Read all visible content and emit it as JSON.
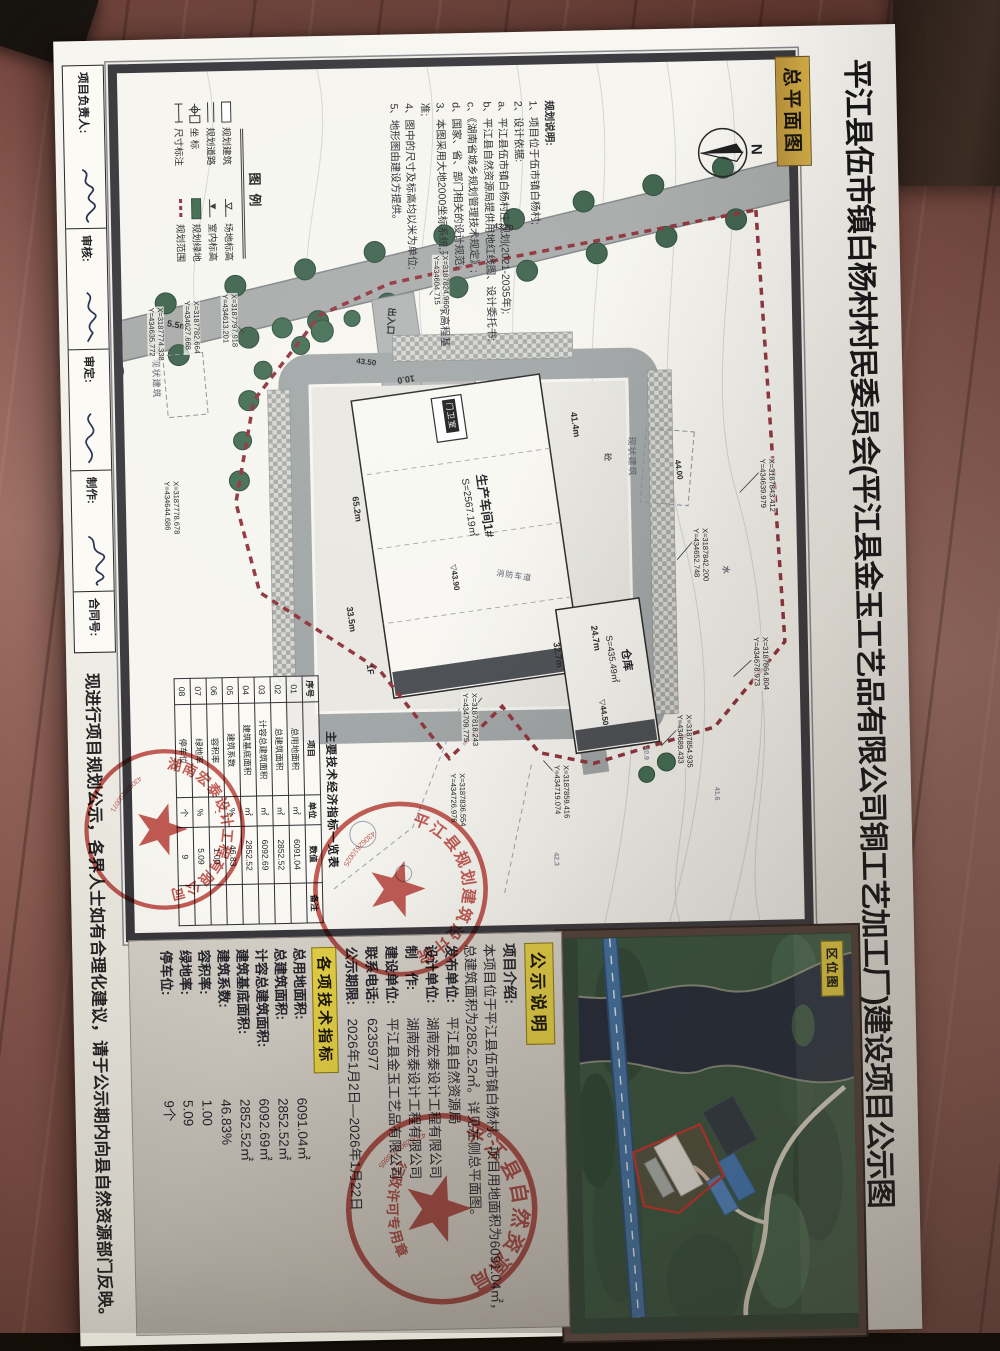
{
  "sheet": {
    "main_title": "平江县伍市镇白杨村村民委员会(平江县金玉工艺品有限公司铜工艺加工厂)建设项目公示图",
    "plan_label": "总平面图",
    "bottom_notice": "现进行项目规划公示，各界人士如有合理化建议，请于公示期内向县自然资源部门反映。",
    "title_block": {
      "fields": [
        "项目负责人:",
        "审核:",
        "审定:",
        "制作:",
        "合同号:"
      ]
    }
  },
  "plan": {
    "north_label": "N",
    "notes": [
      "规划说明:",
      "1、项目位于伍市镇白杨村;",
      "2、设计依据:",
      "a、平江县伍市镇白杨村庄规划(2021-2035年);",
      "b、平江县自然资源局提供用地红线图、设计委托书;",
      "c、《湖南省城乡规划管理技术规定》;",
      "d、国家、省、部门相关的设计规范;",
      "3、本图采用大地2000坐标系统,采用1985国家高程基准;",
      "4、图中的尺寸及标高均以米为单位;",
      "5、地形图由建设方提供。"
    ],
    "legend": {
      "title": "图例",
      "items": [
        "规划建筑",
        "规划道路",
        "坐 标",
        "尺寸标注",
        "场地标高",
        "室内标高",
        "规划绿地",
        "规划范围"
      ]
    },
    "buildings": {
      "workshop": {
        "name": "生产车间1#",
        "area": "S=2567.19㎡",
        "elevation": "43.90",
        "floors": "1F",
        "dim_length": "65.2m",
        "dim_width": "41.4m",
        "dim_wing": "24.7m",
        "dim_side": "33.5m"
      },
      "warehouse": {
        "name": "仓库",
        "area": "S=435.49㎡",
        "elevation": "44.50",
        "dim_length": "32.7m"
      },
      "guard_room": "门卫室"
    },
    "labels": {
      "entrance": "出入口",
      "existing_building": "现状建筑",
      "fire_lane": "消防车道",
      "concrete": "砼",
      "water": "水",
      "road_width": "5.5m",
      "drive_width": "10.0"
    },
    "spot_elevations": [
      "43.20",
      "43.50",
      "44.00",
      "41.6",
      "42.3",
      "40.9"
    ],
    "coordinates": [
      {
        "x": "X=3187824.960",
        "y": "Y=434604.715"
      },
      {
        "x": "X=3187797.918",
        "y": "Y=434613.201"
      },
      {
        "x": "X=3187782.664",
        "y": "Y=434627.668"
      },
      {
        "x": "X=3187774.338",
        "y": "Y=434635.772"
      },
      {
        "x": "X=3187778.678",
        "y": "Y=434644.686"
      },
      {
        "x": "X=3187843.412",
        "y": "Y=434639.979"
      },
      {
        "x": "X=3187842.200",
        "y": "Y=434652.748"
      },
      {
        "x": "X=3187864.804",
        "y": "Y=434678.973"
      },
      {
        "x": "X=3187854.935",
        "y": "Y=434689.433"
      },
      {
        "x": "X=3187859.416",
        "y": "Y=434719.074"
      },
      {
        "x": "X=3187818.243",
        "y": "Y=434709.775"
      },
      {
        "x": "X=3187836.554",
        "y": "Y=434726.976"
      }
    ],
    "econ_table": {
      "title": "主要技术经济指标一览表",
      "headers": [
        "序号",
        "项目",
        "单位",
        "数值",
        "备注"
      ],
      "rows": [
        [
          "01",
          "总用地面积",
          "㎡",
          "6091.04",
          ""
        ],
        [
          "02",
          "总建筑面积",
          "㎡",
          "2852.52",
          ""
        ],
        [
          "03",
          "计容总建筑面积",
          "㎡",
          "6092.69",
          ""
        ],
        [
          "04",
          "建筑基底面积",
          "㎡",
          "2852.52",
          ""
        ],
        [
          "05",
          "建筑系数",
          "%",
          "46.83",
          ""
        ],
        [
          "06",
          "容积率",
          "-",
          "1.00",
          ""
        ],
        [
          "07",
          "绿地率",
          "%",
          "5.09",
          ""
        ],
        [
          "08",
          "停车位",
          "个",
          "9",
          ""
        ]
      ]
    }
  },
  "location_map": {
    "label": "区位图"
  },
  "notice_panel": {
    "header": "公示说明",
    "intro_label": "项目介绍:",
    "intro_text": "本项目位于平江县伍市镇白杨村。项目用地面积为6091.04㎡，总建筑面积为2852.52㎡。详见左侧总平面图。",
    "fields": [
      {
        "label": "发布单位:",
        "value": "平江县自然资源局"
      },
      {
        "label": "设计单位:",
        "value": "湖南宏泰设计工程有限公司"
      },
      {
        "label": "制　作:",
        "value": "湖南宏泰设计工程有限公司"
      },
      {
        "label": "建设单位:",
        "value": "平江县金玉工艺品有限公司"
      },
      {
        "label": "联系电话:",
        "value": "6235977"
      },
      {
        "label": "公示期限:",
        "value": "2026年1月2日—2026年1月22日"
      }
    ],
    "tech_header": "各项技术指标",
    "indicators": [
      {
        "label": "总用地面积:",
        "value": "6091.04㎡"
      },
      {
        "label": "总建筑面积:",
        "value": "2852.52㎡"
      },
      {
        "label": "计容总建筑面积:",
        "value": "6092.69㎡"
      },
      {
        "label": "建筑基底面积:",
        "value": "2852.52㎡"
      },
      {
        "label": "建筑系数:",
        "value": "46.83%"
      },
      {
        "label": "容积率:",
        "value": "1.00"
      },
      {
        "label": "绿地率:",
        "value": "5.09"
      },
      {
        "label": "停车位:",
        "value": "9个"
      }
    ]
  },
  "stamps": [
    {
      "arc": "湖南宏泰设计工程有限公司",
      "serial": "430626100071"
    },
    {
      "arc": "平江县规划建筑设计院",
      "serial": "43062610025"
    },
    {
      "arc": "平江县自然资源局",
      "banner": "行政许可专用章",
      "serial": "43062800023865"
    }
  ],
  "colors": {
    "stamp_red": "#b8342e",
    "highlight_yellow": "#e3cf43",
    "boundary_red": "#8e3039",
    "tree_green": "#3c614b",
    "planned_green": "#3f6b50",
    "water_dark": "#1f2836",
    "highway_blue": "#3f6f9e",
    "frame_black": "#38373c",
    "gold_label": "#c8a43c"
  }
}
